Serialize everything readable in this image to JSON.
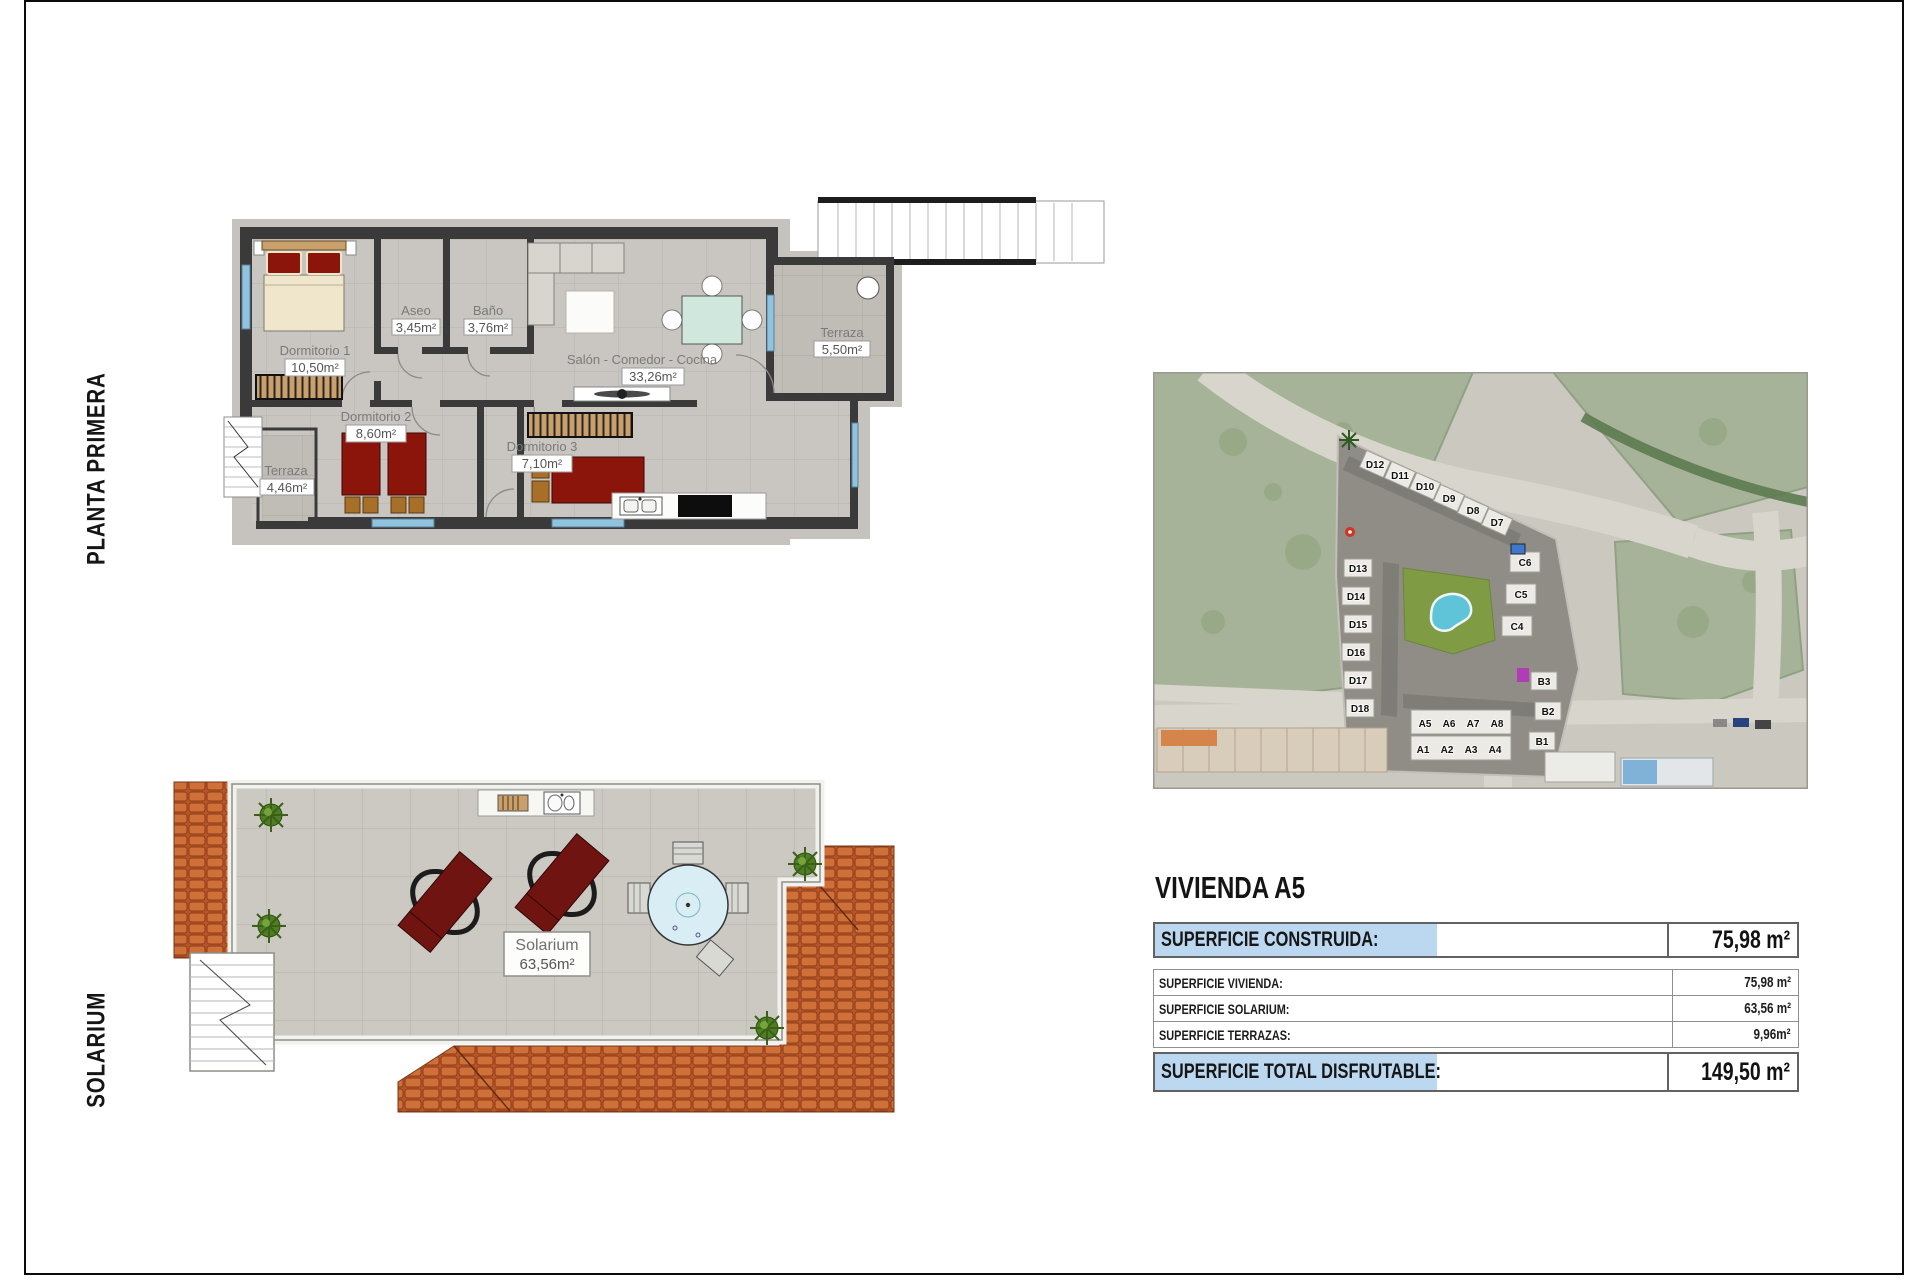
{
  "sheet": {
    "left_labels": {
      "planta_primera": "PLANTA PRIMERA",
      "solarium": "SOLARIUM"
    }
  },
  "floor_plan": {
    "rooms": {
      "dormitorio1": {
        "name": "Dormitorio 1",
        "area": "10,50m²"
      },
      "aseo": {
        "name": "Aseo",
        "area": "3,45m²"
      },
      "bano": {
        "name": "Baño",
        "area": "3,76m²"
      },
      "salon": {
        "name": "Salón - Comedor - Cocina",
        "area": "33,26m²"
      },
      "dormitorio2": {
        "name": "Dormitorio 2",
        "area": "8,60m²"
      },
      "dormitorio3": {
        "name": "Dormitorio 3",
        "area": "7,10m²"
      },
      "terraza_izq": {
        "name": "Terraza",
        "area": "4,46m²"
      },
      "terraza_der": {
        "name": "Terraza",
        "area": "5,50m²"
      }
    }
  },
  "solarium_plan": {
    "room": {
      "name": "Solarium",
      "area": "63,56m²"
    }
  },
  "site_plan": {
    "unit_labels": [
      "D12",
      "D11",
      "D10",
      "D9",
      "D8",
      "D7",
      "D13",
      "D14",
      "D15",
      "D16",
      "D17",
      "D18",
      "C6",
      "C5",
      "C4",
      "A5",
      "A6",
      "A7",
      "A8",
      "A1",
      "A2",
      "A3",
      "A4",
      "B3",
      "B2",
      "B1"
    ]
  },
  "summary": {
    "title": "VIVIENDA A5",
    "construida": {
      "label": "SUPERFICIE CONSTRUIDA:",
      "value": "75,98 m²"
    },
    "detail_rows": [
      {
        "label": "SUPERFICIE VIVIENDA:",
        "value": "75,98 m²"
      },
      {
        "label": "SUPERFICIE SOLARIUM:",
        "value": "63,56 m²"
      },
      {
        "label": "SUPERFICIE TERRAZAS:",
        "value": "9,96m²"
      }
    ],
    "total": {
      "label": "SUPERFICIE TOTAL DISFRUTABLE:",
      "value": "149,50 m²"
    }
  },
  "colors": {
    "highlight_blue": "#bcd8f0",
    "wall_dark": "#3a3a3a",
    "floor_tile": "#c9c6c1",
    "roof_terracotta": "#c2632f",
    "furniture_red": "#8c150b",
    "dining_table_teal": "#cfe7dd",
    "pool_blue": "#5fc4d8",
    "lawn_green": "#7f9c44",
    "field_green": "#a6b398",
    "window_blue": "#8fc3de"
  }
}
